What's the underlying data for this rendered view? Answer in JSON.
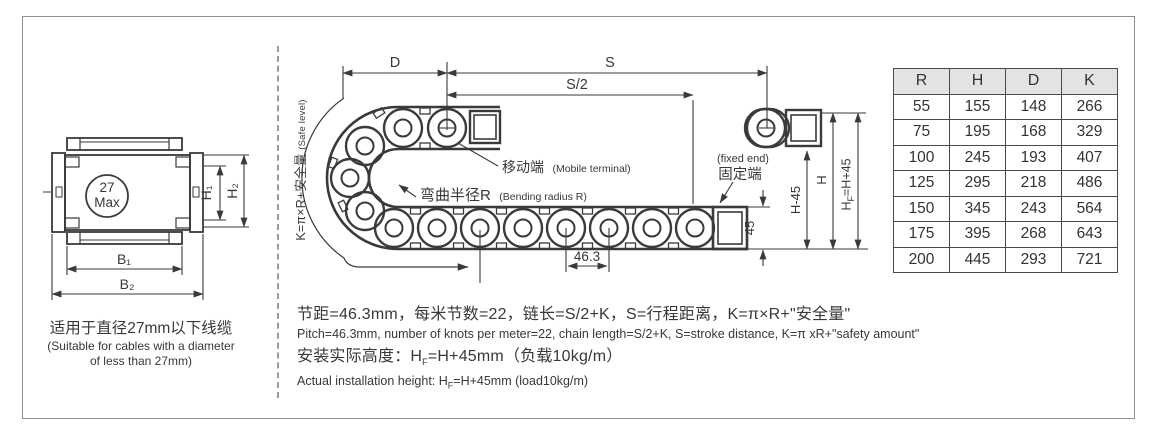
{
  "left_section": {
    "cross_section": {
      "circle_line1": "27",
      "circle_line2": "Max",
      "dim_h1": "H₁",
      "dim_h2": "H₂",
      "dim_b1": "B₁",
      "dim_b2": "B₂"
    },
    "caption_cn": "适用于直径27mm以下线缆",
    "caption_en_line1": "(Suitable for cables with a diameter",
    "caption_en_line2": "of less than 27mm)"
  },
  "diagram": {
    "safe_level_main": "K=π×R+安全量",
    "safe_level_sub": "(Safe level)",
    "dim_d": "D",
    "dim_s": "S",
    "dim_s_half": "S/2",
    "mobile_terminal_cn": "移动端",
    "mobile_terminal_en": "(Mobile terminal)",
    "bending_radius_cn": "弯曲半径R",
    "bending_radius_en": "(Bending radius R)",
    "fixed_end_en": "(fixed end)",
    "fixed_end_cn": "固定端",
    "dim_pitch": "46.3",
    "dim_45": "45",
    "dim_h_minus_45": "H-45",
    "dim_h": "H",
    "dim_hf": "H_{F}=H+45"
  },
  "notes": {
    "line1_cn": "节距=46.3mm，每米节数=22，链长=S/2+K，S=行程距离，K=π×R+\"安全量\"",
    "line1_en": "Pitch=46.3mm, number of knots per meter=22, chain length=S/2+K, S=stroke distance, K=π xR+\"safety amount\"",
    "line2_cn": "安装实际高度：H_{F}=H+45mm（负载10kg/m）",
    "line2_en": "Actual installation height: H_{F}=H+45mm (load10kg/m)"
  },
  "spec_table": {
    "headers": [
      "R",
      "H",
      "D",
      "K"
    ],
    "rows": [
      [
        55,
        155,
        148,
        266
      ],
      [
        75,
        195,
        168,
        329
      ],
      [
        100,
        245,
        193,
        407
      ],
      [
        125,
        295,
        218,
        486
      ],
      [
        150,
        345,
        243,
        564
      ],
      [
        175,
        395,
        268,
        643
      ],
      [
        200,
        445,
        293,
        721
      ]
    ]
  },
  "colors": {
    "line": "#3a3a3a",
    "frame": "#8f8f8f",
    "table_header_bg": "#e3e3e3"
  }
}
